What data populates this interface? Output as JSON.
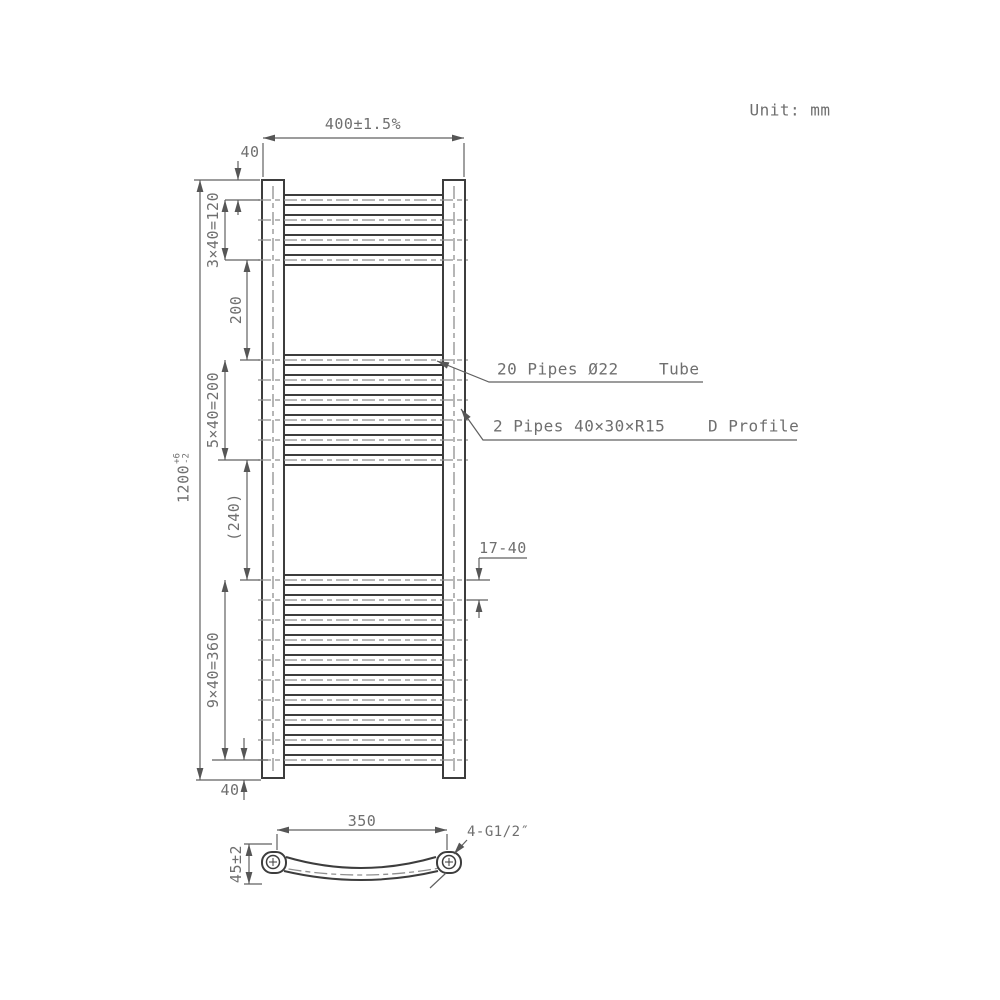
{
  "unit_label": "Unit: mm",
  "front_view": {
    "dim_width": "400±1.5%",
    "dim_top_offset": "40",
    "dim_group1": "3×40=120",
    "dim_gap1": "200",
    "dim_group2": "5×40=200",
    "dim_gap2": "(240)",
    "dim_group3": "9×40=360",
    "dim_bottom_offset": "40",
    "dim_pipe_spacing": "17-40",
    "dim_height": {
      "value": "1200",
      "tol_plus": "+6",
      "tol_minus": "-2"
    },
    "tube_label": {
      "text": "20 Pipes Ø22",
      "suffix": "Tube"
    },
    "profile_label": {
      "text": "2 Pipes 40×30×R15",
      "suffix": "D Profile"
    },
    "pipes": {
      "total_count": 20,
      "spacing_mm": 40,
      "groups": [
        {
          "count": 4,
          "first_center_mm": 40
        },
        {
          "count": 6,
          "first_center_mm": 360
        },
        {
          "count": 10,
          "first_center_mm": 800
        }
      ]
    }
  },
  "top_view": {
    "dim_width": "350",
    "dim_depth": "45±2",
    "thread_label": "4-G1/2″"
  }
}
